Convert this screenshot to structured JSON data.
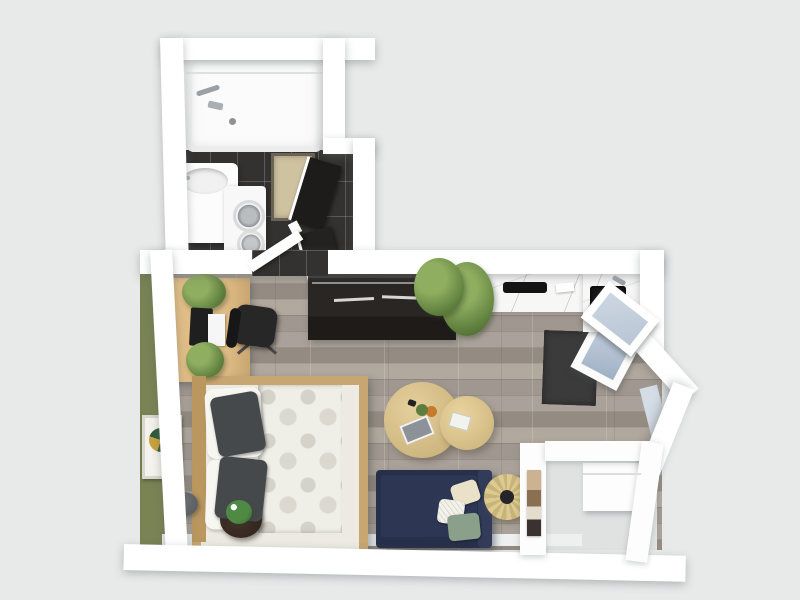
{
  "scene": {
    "kind": "3d-floorplan-top-view",
    "description": "Top-down 3D render of a studio apartment floor plan on a plain light-gray background. No text labels are visible in the image.",
    "background_color": "#e8eaea"
  },
  "palette": {
    "outer_walls": "#ffffff",
    "accent_wall_green": "#7a8354",
    "bathroom_tile": "#343230",
    "wood_floor": "#a09890",
    "desk_and_bed_wood": "#d9b77f",
    "sideboard_dark": "#2a2624",
    "sofa_navy": "#27304a",
    "counter_marble": "#f7f7f6",
    "rug_charcoal": "#3b3b3b",
    "coffee_table_wood": "#dcc692",
    "rattan_table": "#d6c489",
    "bath_mat": "#cfc2a1",
    "pillow_charcoal": "#46494b",
    "cushion_sage": "#8ba08b",
    "cushion_cream": "#e9e2c8"
  },
  "rooms": [
    {
      "name": "bathroom",
      "floor": "dark ceramic tile",
      "position": "top-left"
    },
    {
      "name": "main-living-sleeping-area",
      "floor": "gray-brown wood planks",
      "position": "center-left"
    },
    {
      "name": "kitchen-strip",
      "floor": "wood planks",
      "position": "top-right"
    },
    {
      "name": "entry-alcove",
      "floor": "light gray",
      "position": "bottom-right"
    }
  ],
  "furniture": {
    "bathroom": [
      "white bathtub with shower fixture",
      "white vanity sink unit",
      "stacked white washer-dryer with round doors",
      "beige bath mat with dark border",
      "black open bifold closet doors",
      "white open door leaf"
    ],
    "living": [
      "olive green accent wall",
      "wooden desk",
      "black laptop",
      "white papers",
      "desk plants",
      "black office swivel chair",
      "dark wood sideboard with two metal handles",
      "potted green plant beside sideboard",
      "double bed with wood frame",
      "white botanical-pattern duvet",
      "two charcoal pillows",
      "two white pillows",
      "framed green-gold botanical artwork",
      "dark round planter with white flowers",
      "gray round pouf",
      "two round nesting coffee tables with books and decor",
      "navy blue sofa",
      "cream cushion",
      "white patterned cushion",
      "sage green cushion",
      "round rattan side table with dark center",
      "charcoal area rug"
    ],
    "kitchen": [
      "white marble countertop",
      "black cooktop",
      "black square sink with faucet",
      "potted plant on counter end"
    ],
    "entry": [
      "white partition wall with framed artwork",
      "white cabinet appliance",
      "open glazed entry door",
      "open white appliance door with blue interior",
      "chamfered corner wall with window panes"
    ]
  }
}
